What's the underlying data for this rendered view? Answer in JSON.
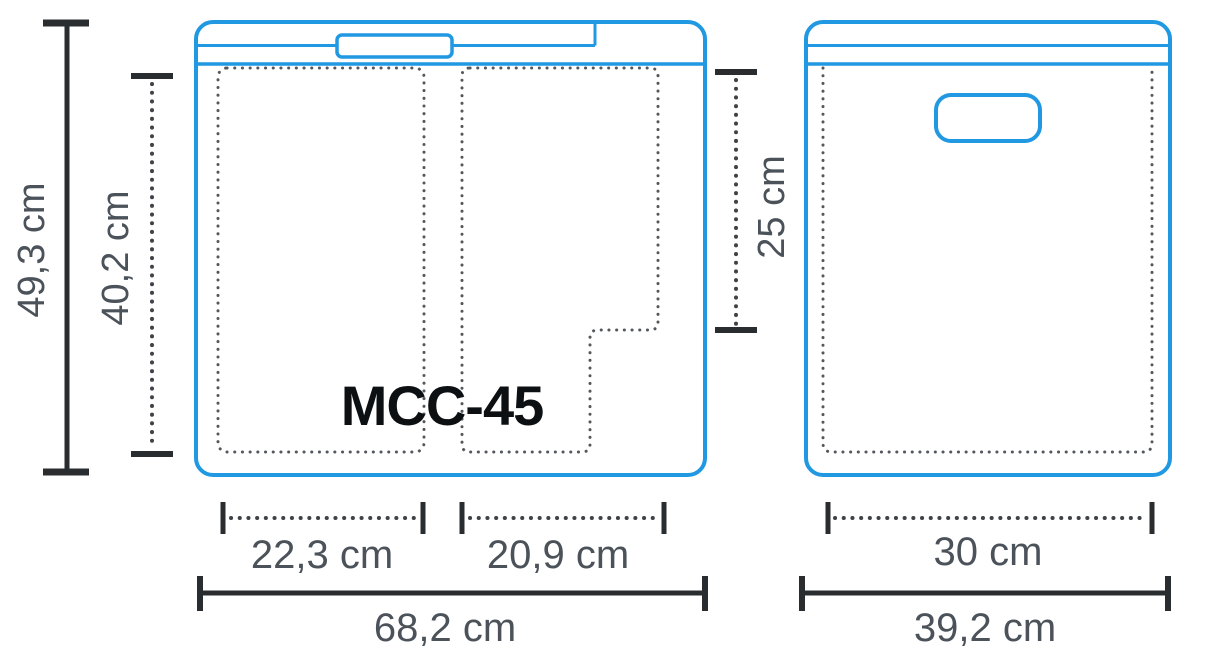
{
  "diagram": {
    "model": "MCC-45",
    "front_view": {
      "outer_height": "49,3 cm",
      "inner_height": "40,2 cm",
      "inner_width_left": "22,3 cm",
      "inner_width_right": "20,9 cm",
      "outer_width": "68,2 cm"
    },
    "side_view": {
      "inner_height": "25 cm",
      "inner_width": "30 cm",
      "outer_width": "39,2 cm"
    },
    "colors": {
      "outline_blue": "#2198e2",
      "dimension_dark": "#2a2d30",
      "dimension_dotted_gray": "#3f4348",
      "interior_dotted_gray": "#54585d",
      "label_text": "#4b525a",
      "model_text": "#0d1013"
    }
  }
}
